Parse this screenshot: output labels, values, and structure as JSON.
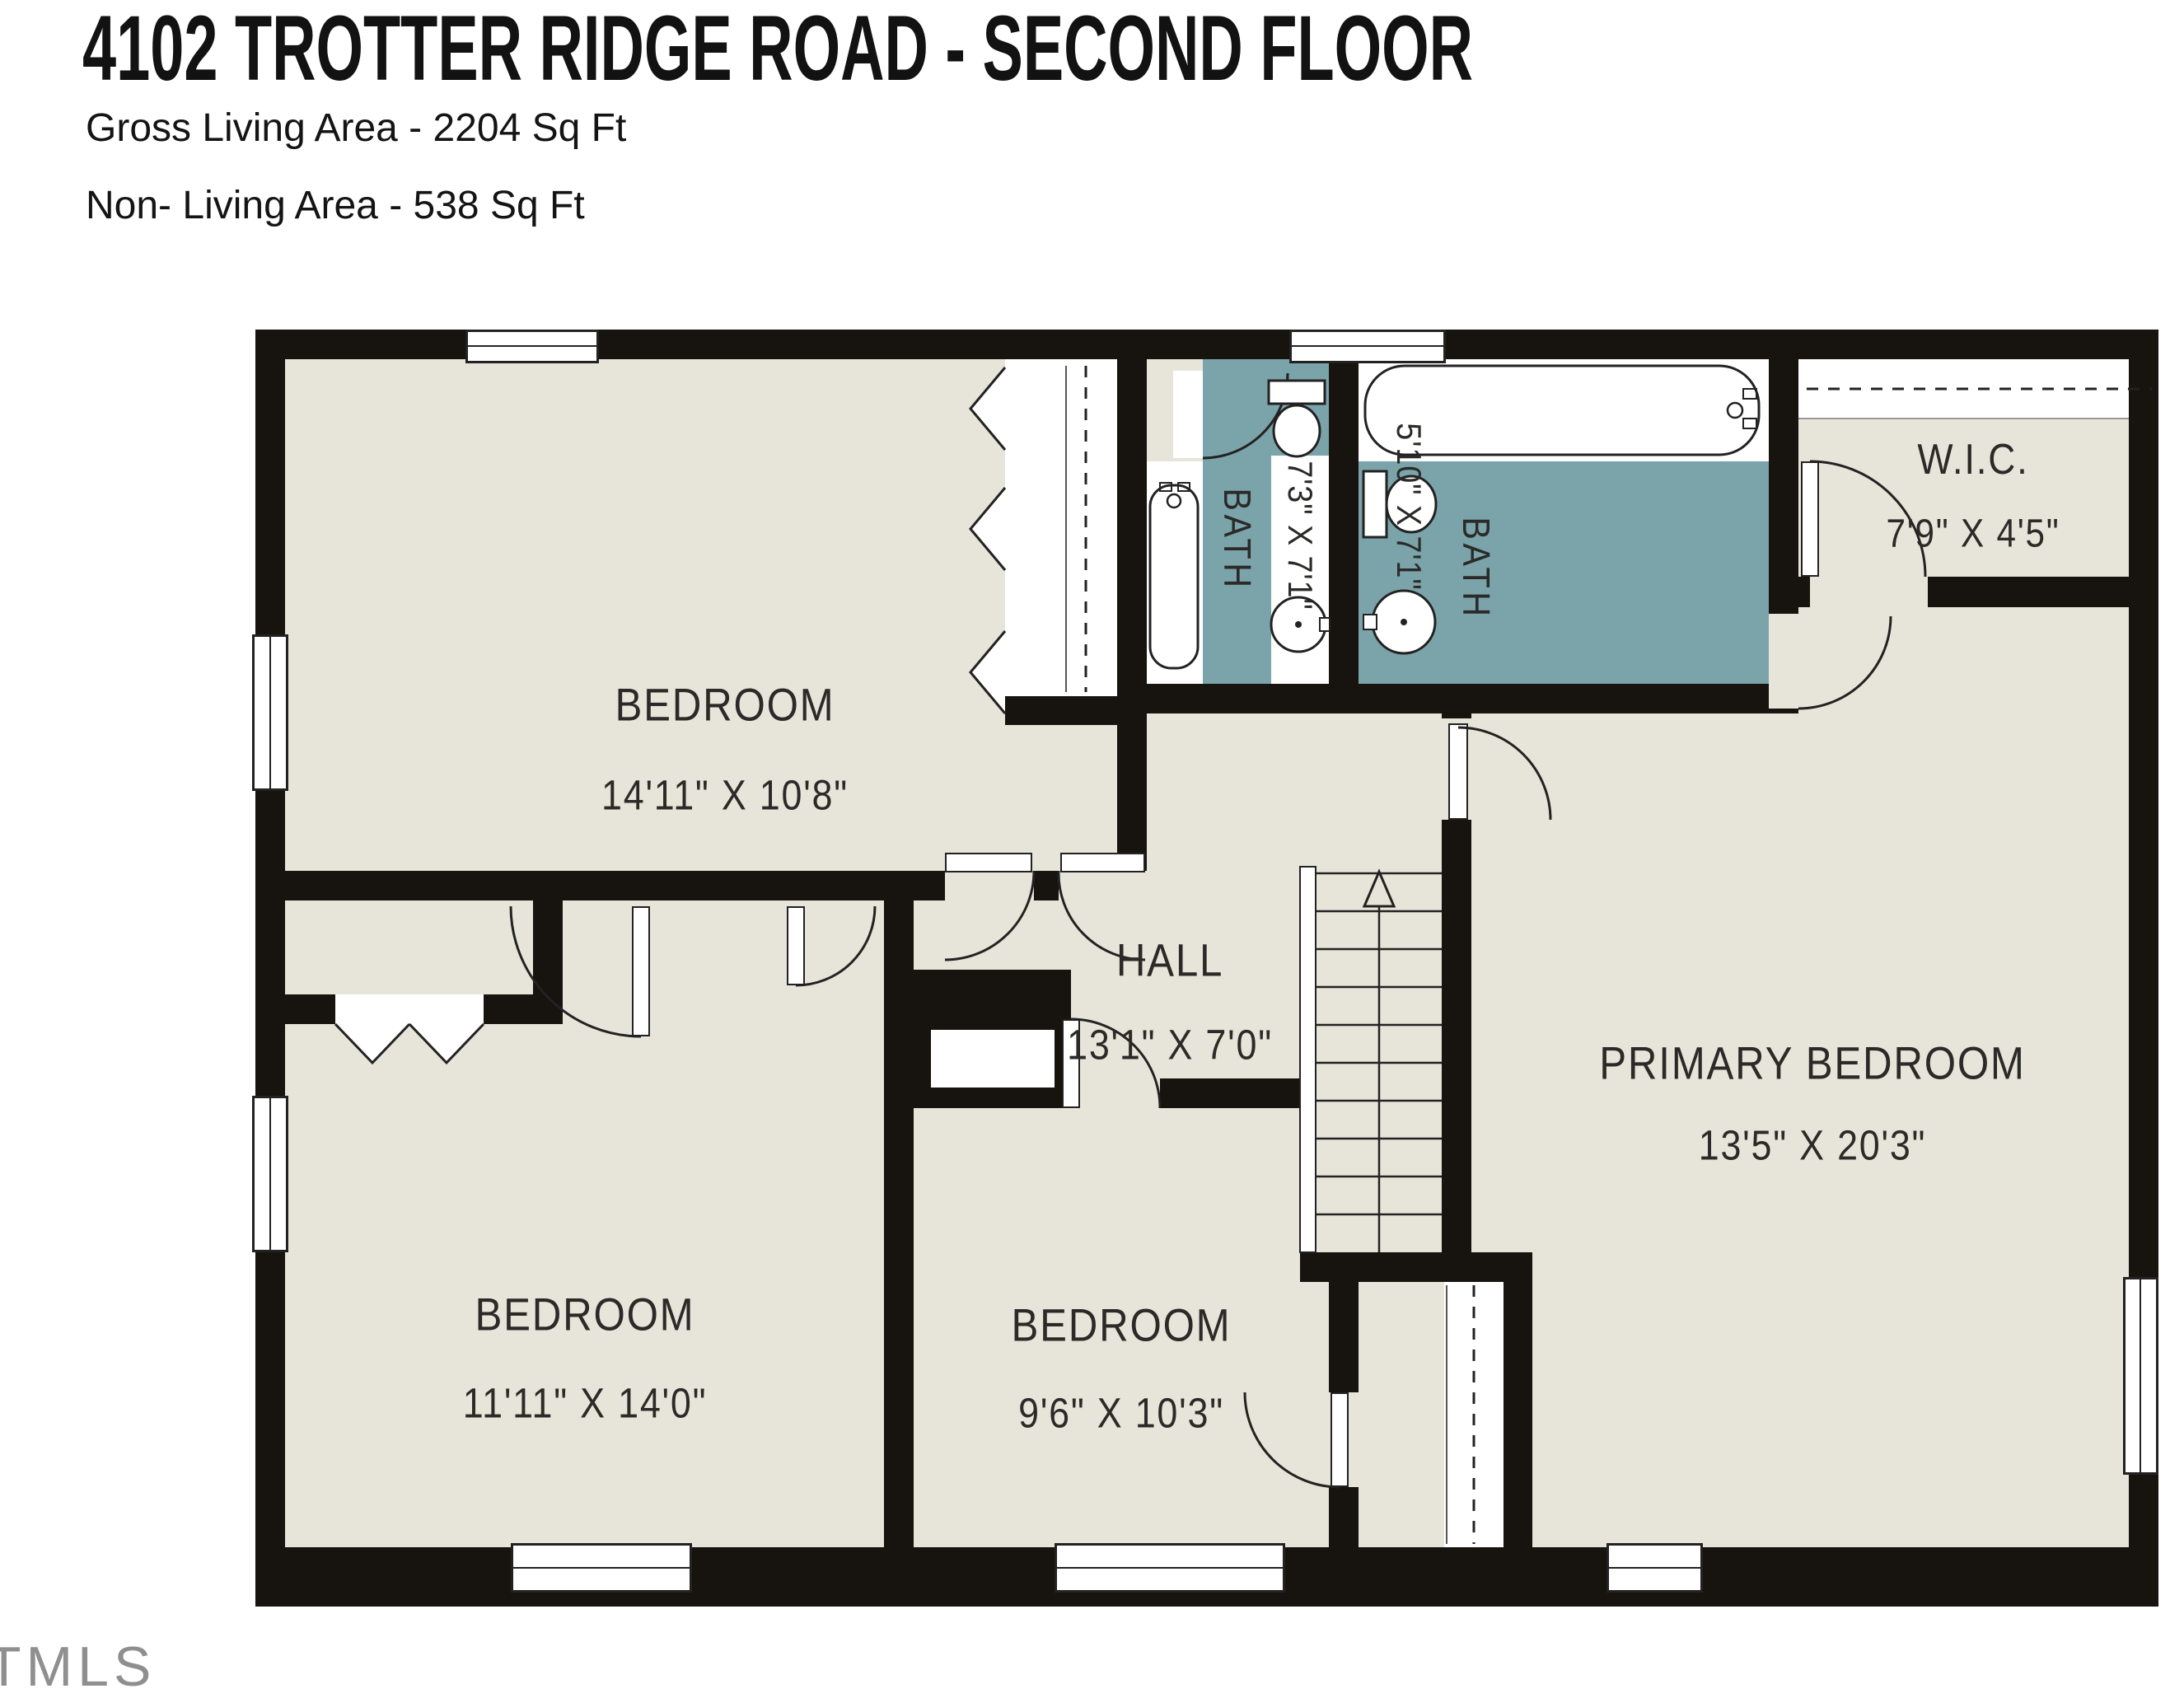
{
  "header": {
    "title": "4102 TROTTER RIDGE ROAD - SECOND FLOOR",
    "gross_living": "Gross Living Area - 2204 Sq Ft",
    "non_living": "Non- Living Area - 538 Sq Ft"
  },
  "watermark": "TMLS",
  "colors": {
    "floor_beige": "#e7e5d9",
    "bath_teal": "#7aa4aa",
    "wall_black": "#17140f",
    "fixture_white": "#ffffff",
    "label_text": "#2b2a28"
  },
  "rooms": {
    "bedroom_top_left": {
      "label": "BEDROOM",
      "dims": "14'11\" X 10'8\""
    },
    "bedroom_bottom_left": {
      "label": "BEDROOM",
      "dims": "11'11\" X 14'0\""
    },
    "bedroom_bottom_middle": {
      "label": "BEDROOM",
      "dims": "9'6\" X 10'3\""
    },
    "primary_bedroom": {
      "label": "PRIMARY BEDROOM",
      "dims": "13'5\" X 20'3\""
    },
    "hall": {
      "label": "HALL",
      "dims": "13'1\" X 7'0\""
    },
    "bath_hall": {
      "label": "BATH",
      "dims": "7'3\" X 7'1\""
    },
    "bath_primary": {
      "label": "BATH",
      "dims": "5'10\" X 7'1\""
    },
    "wic": {
      "label": "W.I.C.",
      "dims": "7'9\" X 4'5\""
    }
  }
}
